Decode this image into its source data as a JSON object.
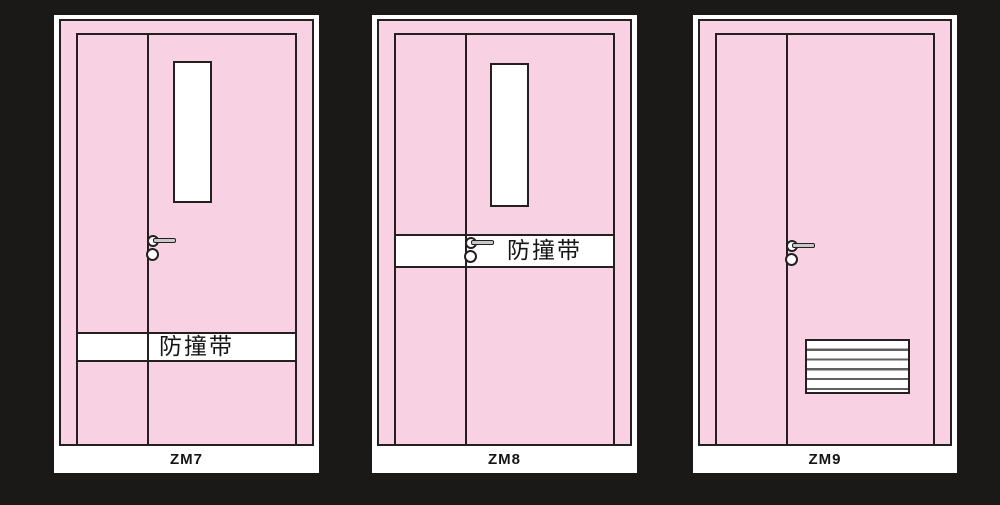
{
  "colors": {
    "background": "#1b1818",
    "card": "#ffffff",
    "door_fill": "#f8d2e2",
    "outline": "#241f21",
    "lever": "#c8c8c8",
    "louver_line": "#606060",
    "text": "#161616"
  },
  "icons": {
    "door_handle": "circle-rose-with-lever-bar",
    "lock_cylinder": "small-circle",
    "louver_vent": "slatted-rectangle"
  },
  "doors": [
    {
      "label": "ZM7",
      "band_text": "防撞带"
    },
    {
      "label": "ZM8",
      "band_text": "防撞带"
    },
    {
      "label": "ZM9"
    }
  ]
}
